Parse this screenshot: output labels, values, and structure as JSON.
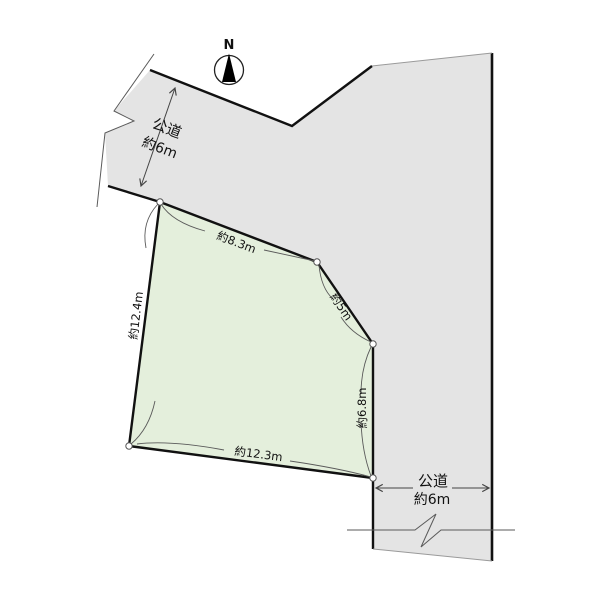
{
  "compass": {
    "label": "N"
  },
  "colors": {
    "road_fill": "#e4e4e4",
    "parcel_fill": "#e4efdc",
    "outline": "#111111",
    "thin_line": "#5a5a5a"
  },
  "parcel": {
    "edge_labels": {
      "top": "約8.3m",
      "upper_right": "約5m",
      "right": "約6.8m",
      "bottom": "約12.3m",
      "left": "約12.4m"
    }
  },
  "roads": {
    "top_left": {
      "name": "公道",
      "width": "約6m"
    },
    "bottom_right": {
      "name": "公道",
      "width": "約6m"
    }
  }
}
